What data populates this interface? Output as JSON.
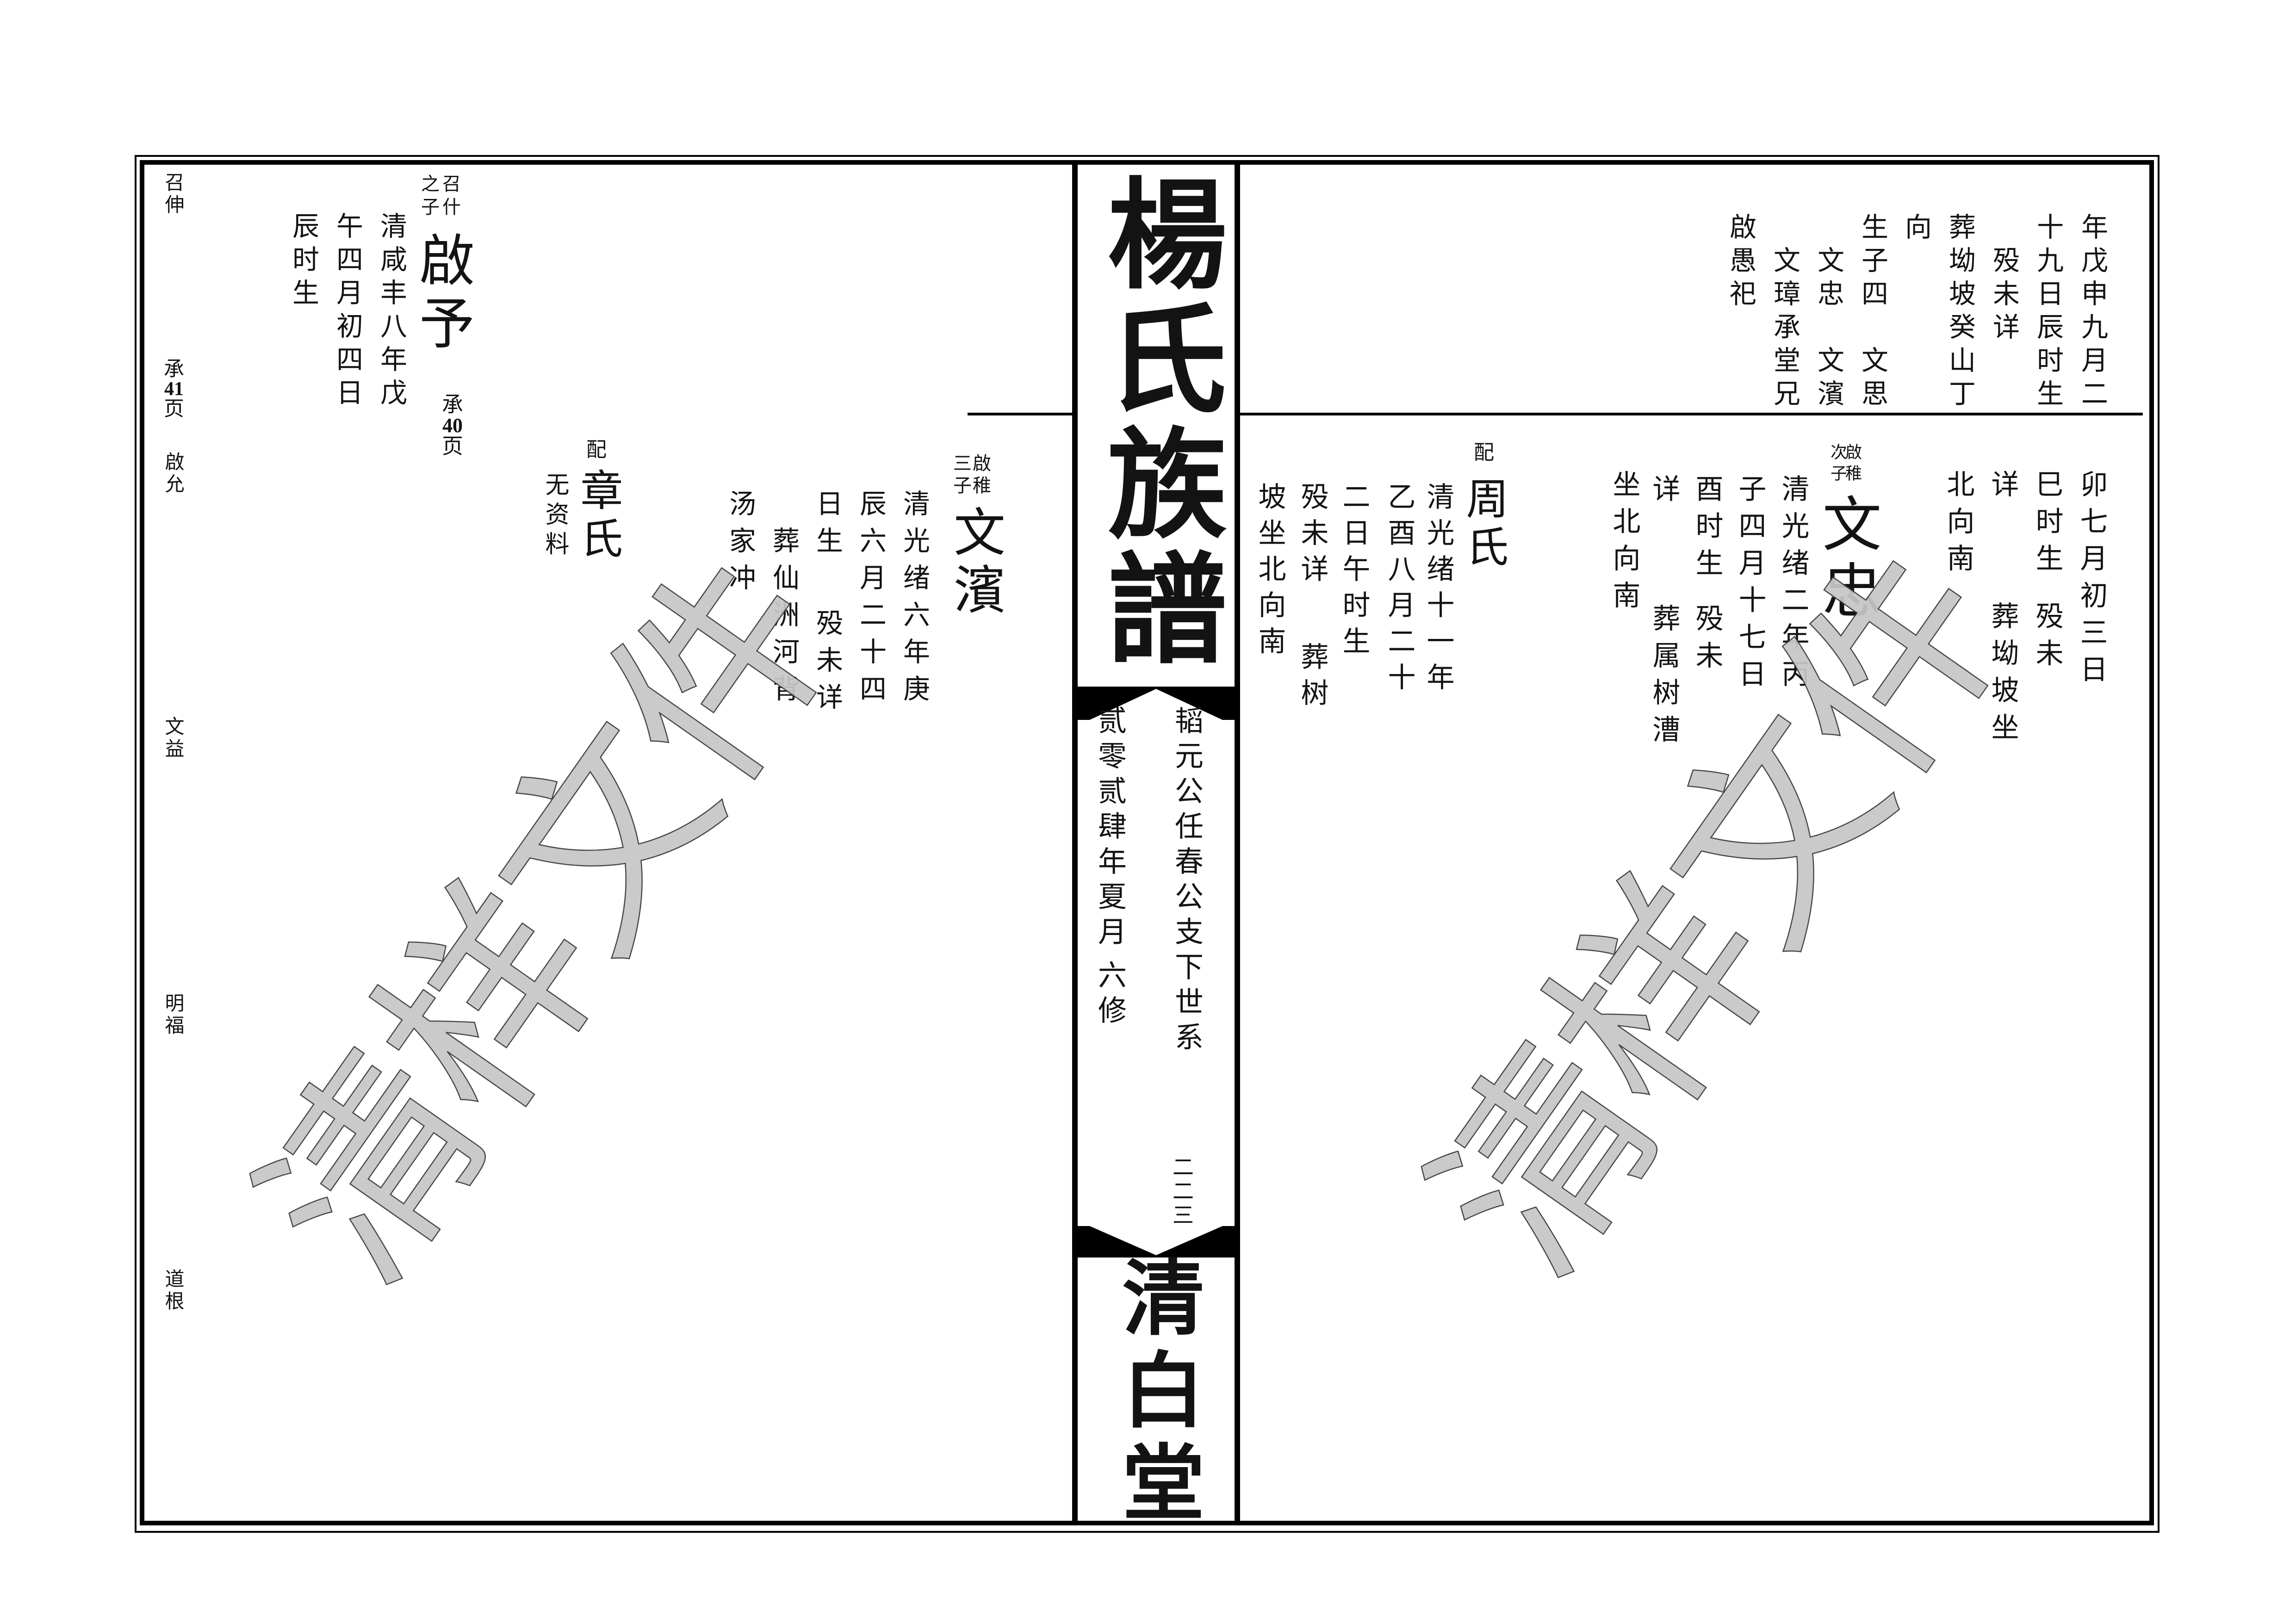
{
  "watermark": {
    "text": "清样文件",
    "color": "#c7c7c7"
  },
  "spine": {
    "title": "楊氏族譜",
    "lineage_line": "韬元公任春公支下世系",
    "edition_date": "贰零贰肆年夏月",
    "edition_no": "六修",
    "page_number": "二二三",
    "hall_name": "清白堂"
  },
  "margin_labels": {
    "m1": "召伸",
    "m2_top": "承",
    "m2_num": "41",
    "m2_bottom": "页",
    "m3": "啟允",
    "m4": "文益",
    "m5": "明福",
    "m6": "道根"
  },
  "left_page": {
    "qiyu": {
      "rel_right": "召什",
      "rel_left": "之子",
      "name": "啟予",
      "cont_top": "承",
      "cont_num": "40",
      "cont_bottom": "页",
      "col1": "清咸丰八年戊",
      "col2": "午四月初四日",
      "col3": "辰时生"
    },
    "peizhang": {
      "label": "配",
      "name": "章氏",
      "col1": "无资料"
    },
    "wenbin": {
      "rel_right": "啟稚",
      "rel_left": "三子",
      "name": "文濱",
      "col1": "清光绪六年庚",
      "col2": "辰六月二十四",
      "col3a": "日生",
      "col3b": "殁未详",
      "col4": "葬仙洲河背",
      "col5": "汤家冲"
    }
  },
  "right_page": {
    "block1": {
      "col1": "年戊申九月二",
      "col2": "十九日辰时生",
      "col3": "殁未详",
      "col4": "葬坳坡癸山丁",
      "col5": "向",
      "col6a": "生子四",
      "col6b": "文思",
      "col7a": "文忠",
      "col7b": "文濱",
      "col8": "文璋承堂兄",
      "col9": "啟愚祀"
    },
    "cont2": {
      "col1": "卯七月初三日",
      "col2a": "巳时生",
      "col2b": "殁未",
      "col3a": "详",
      "col3b": "葬坳坡坐",
      "col4": "北向南"
    },
    "wenzhong": {
      "rel_right": "啟稚",
      "rel_left": "次子",
      "name": "文忠",
      "col1": "清光绪二年丙",
      "col2": "子四月十七日",
      "col3a": "酉时生",
      "col3b": "殁未",
      "col4a": "详",
      "col4b": "葬属树漕",
      "col5": "坐北向南"
    },
    "peizhou": {
      "label": "配",
      "name": "周氏",
      "col1": "清光绪十一年",
      "col2": "乙酉八月二十",
      "col3": "二日午时生",
      "col4a": "殁未详",
      "col4b": "葬树",
      "col5": "坡坐北向南"
    }
  }
}
